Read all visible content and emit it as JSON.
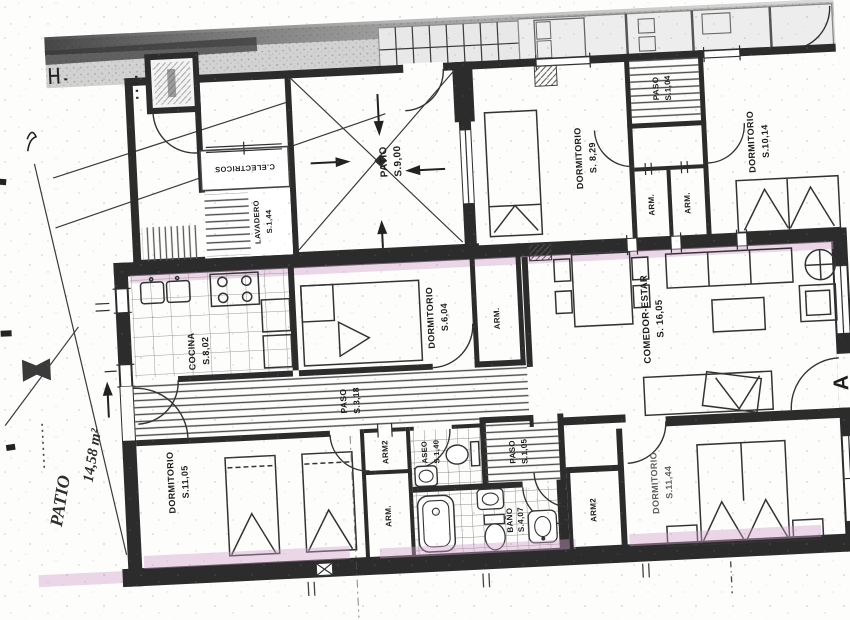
{
  "document": {
    "kind": "scanned architectural floor plan",
    "language": "Spanish"
  },
  "plan": {
    "rooms": {
      "patio_ext": {
        "name": "PATIO",
        "area": "14,58 m²"
      },
      "patio": {
        "name": "PATIO",
        "area": "S.9,00"
      },
      "lavadero": {
        "name": "LAVADERO",
        "area": "S.1,44"
      },
      "electricos": {
        "name": "C.ELECTRICOS",
        "area": ""
      },
      "dorm829": {
        "name": "DORMITORIO",
        "area": "S. 8,29"
      },
      "paso104": {
        "name": "PASO",
        "area": "S.1,04"
      },
      "dorm1014": {
        "name": "DORMITORIO",
        "area": "S.10,14"
      },
      "cocina": {
        "name": "COCINA",
        "area": "S.8,02"
      },
      "dorm604": {
        "name": "DORMITORIO",
        "area": "S.6,04"
      },
      "comedor": {
        "name": "COMEDOR-ESTAR",
        "area": "S. 16,05"
      },
      "paso318": {
        "name": "PASO",
        "area": "S.3,18"
      },
      "aseo": {
        "name": "ASEO",
        "area": "S.1,40"
      },
      "paso105": {
        "name": "PASO",
        "area": "S.1,05"
      },
      "bano": {
        "name": "BAÑO",
        "area": "S.4,07"
      },
      "dorm1105": {
        "name": "DORMITORIO",
        "area": "S.11,05"
      },
      "dorm1144": {
        "name": "DORMITORIO",
        "area": "S.11,44"
      }
    },
    "closets": {
      "upper_a": "ARM.",
      "upper_b": "ARM.",
      "dorm604_side": "ARM.",
      "hall_top": "ARM2",
      "hall_mid": "ARM.",
      "dorm1144_side": "ARM2"
    },
    "markers": {
      "entrance": "A"
    },
    "colors": {
      "highlight": "#cf9fc7",
      "wall": "#2c2c2c",
      "paper": "#fdfdfc",
      "band": "#d2d2d2"
    }
  }
}
